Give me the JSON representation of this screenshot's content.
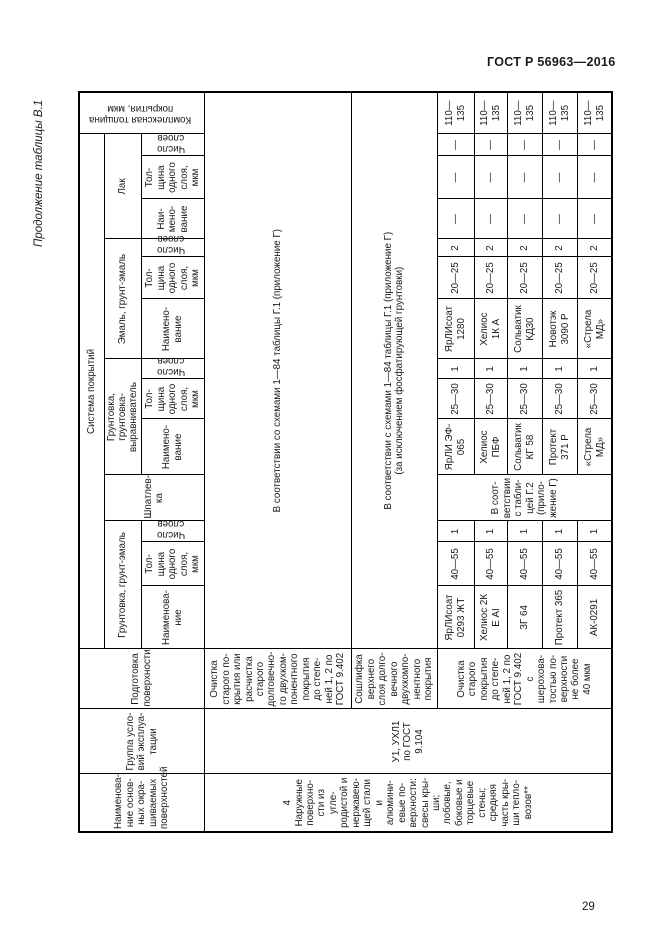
{
  "page": {
    "header": "ГОСТ Р 56963—2016",
    "number": "29",
    "table_caption": "Продолжение таблицы В.1"
  },
  "table": {
    "headers": {
      "surface": "Наименова-\nние основ-\nных окра-\nшиваемых\nповерхностей",
      "service_group": "Группа усло-\nвий эксплуа-\nтации",
      "surface_prep": "Подготовка\nповерхности",
      "coating_system": "Система покрытий",
      "total_thickness": "Комплексная толщина\nпокрытия, мкм",
      "groups": {
        "primer": "Грунтовка, грунт-эмаль",
        "putty": "Шпатлев-\nка",
        "leveling_primer": "Грунтовка,\nгрунтовка-выравниватель",
        "enamel": "Эмаль, грунт-эмаль",
        "varnish": "Лак"
      },
      "leaf": {
        "name_primer": "Наименова-\nние",
        "name_leveling": "Наимено-\nвание",
        "name_enamel": "Наимено-\nвание",
        "name_varnish": "Наи-\nмено-\nвание",
        "thickness": "Тол-\nщина\nодного\nслоя,\nмкм",
        "layers": "Число\nслоев"
      }
    },
    "row4": {
      "surface": "4 Наружные\nповерхно-\nсти из угле-\nродистой и\nнержавею-\nщей стали\nи алюмини-\nевые по-\nверхности:\nсвесы кры-\nши;\nлобовые,\nбоковые и\nторцевые\nстены;\nсредняя\nчасть кры-\nши тепло-\nвозов**",
      "service_group": "У1, УХЛ1\nпо ГОСТ\n9.104",
      "variant_a": {
        "prep": "Очистка\nстарого по-\nкрытия или\nрасчистка\nстарого\nдолговечно-\nго двухком-\nпонентного\nпокрытия\nдо степе-\nней 1, 2 по\nГОСТ 9.402",
        "system": "В соответствии со схемами 1—84 таблицы Г.1 (приложение Г)"
      },
      "variant_b": {
        "prep": "Сошлифка\nверхнего\nслоя долго-\nвечного\nдвухкомпо-\nнентного\nпокрытия",
        "system": "В соответствии с схемами 1—84 таблицы Г.1 (приложение Г)\n(за исключением фосфатирующей грунтовки)"
      },
      "variant_c": {
        "prep": "Очистка\nстарого\nпокрытия\nдо степе-\nней 1, 2 по\nГОСТ 9.402\nс шерохова-\nтостью по-\nверхности\nне более\n40 мкм",
        "putty": "В соот-\nветствии\nс табли-\nцей Г.2\n(прило-\nжение Г)",
        "systems": [
          {
            "primer": "ЯрЛИсоат\n0293 ЖТ",
            "primer_thk": "40—55",
            "primer_n": "1",
            "lev": "ЯрЛИ ЭФ-\n065",
            "lev_thk": "25—30",
            "lev_n": "1",
            "enamel": "ЯрЛИсоат\n1280",
            "enamel_thk": "20—25",
            "enamel_n": "2",
            "var_name": "—",
            "var_thk": "—",
            "var_n": "—",
            "total": "110—\n135"
          },
          {
            "primer": "Хелиос 2К\nЕ АI",
            "primer_thk": "40—55",
            "primer_n": "1",
            "lev": "Хелиос\nПБФ",
            "lev_thk": "25—30",
            "lev_n": "1",
            "enamel": "Хелиос\n1К А",
            "enamel_thk": "20—25",
            "enamel_n": "2",
            "var_name": "—",
            "var_thk": "—",
            "var_n": "—",
            "total": "110—\n135"
          },
          {
            "primer": "ЗГ 64",
            "primer_thk": "40—55",
            "primer_n": "1",
            "lev": "Сольватик\nКГ 58",
            "lev_thk": "25—30",
            "lev_n": "1",
            "enamel": "Сольватик\nКД30",
            "enamel_thk": "20—25",
            "enamel_n": "2",
            "var_name": "—",
            "var_thk": "—",
            "var_n": "—",
            "total": "110—\n135"
          },
          {
            "primer": "Протект 365",
            "primer_thk": "40—55",
            "primer_n": "1",
            "lev": "Протект\n371 Р",
            "lev_thk": "25—30",
            "lev_n": "1",
            "enamel": "Новотэк\n3090 Р",
            "enamel_thk": "20—25",
            "enamel_n": "2",
            "var_name": "—",
            "var_thk": "—",
            "var_n": "—",
            "total": "110—\n135"
          },
          {
            "primer": "АК-0291",
            "primer_thk": "40—55",
            "primer_n": "1",
            "lev": "«Стрела\nМД»",
            "lev_thk": "25—30",
            "lev_n": "1",
            "enamel": "«Стрела\nМД»",
            "enamel_thk": "20—25",
            "enamel_n": "2",
            "var_name": "—",
            "var_thk": "—",
            "var_n": "—",
            "total": "110—\n135"
          }
        ]
      }
    }
  }
}
